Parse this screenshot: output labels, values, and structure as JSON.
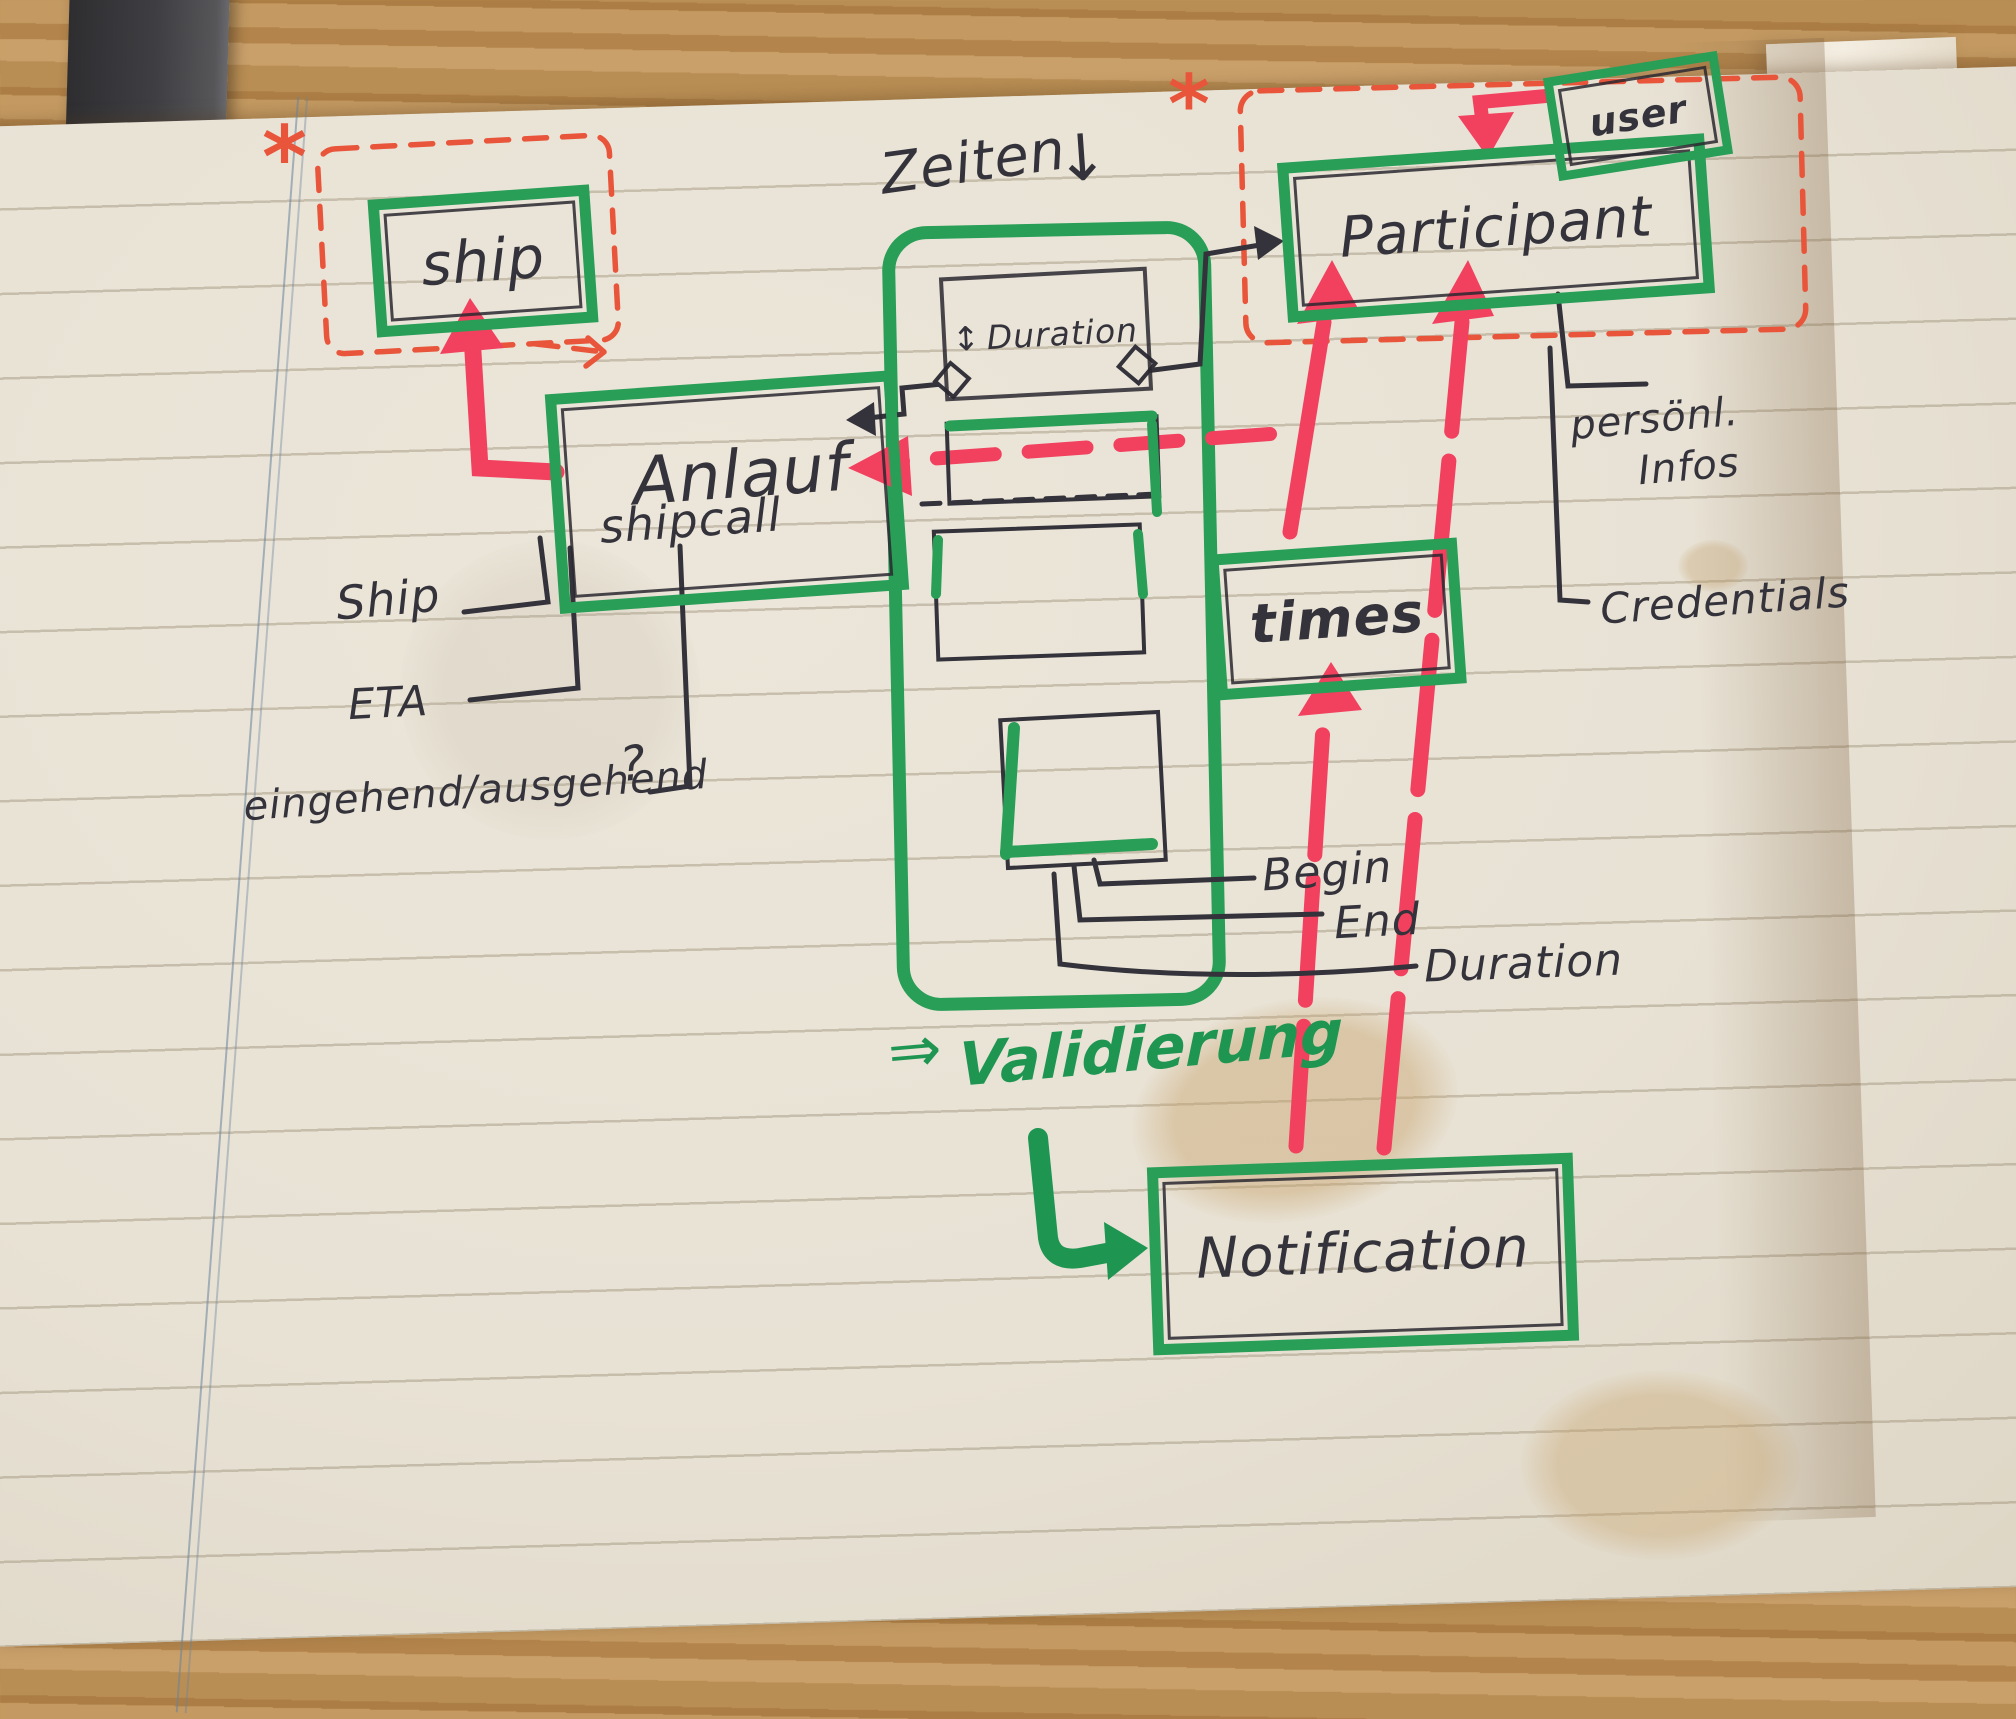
{
  "meta": {
    "description": "Hand-drawn entity sketch (ship call data model) in a paper notebook"
  },
  "colors": {
    "green_marker": "#289e57",
    "red_marker": "#f2415e",
    "orange_dashed": "#e8553a",
    "ink": "#34323a",
    "paper": "#e8e2d5"
  },
  "boxes": {
    "ship": {
      "label": "ship"
    },
    "anlauf": {
      "label_main": "Anlauf",
      "label_sub": "shipcall"
    },
    "duration": {
      "label": "Duration",
      "resize_icon": "↕"
    },
    "participant": {
      "label": "Participant"
    },
    "user": {
      "label": "user"
    },
    "times": {
      "label": "times"
    },
    "notification": {
      "label": "Notification"
    }
  },
  "labels": {
    "zeiten": "Zeiten",
    "zeiten_arrow": "↓",
    "asterisk_left": "*",
    "asterisk_right": "*",
    "ship_attr": "Ship",
    "eta": "ETA",
    "in_out": "eingehend/ausgehend",
    "question_mark": "?",
    "begin": "Begin",
    "end": "End",
    "duration_attr": "Duration",
    "personal_line1": "persönl.",
    "personal_line2": "Infos",
    "credentials": "Credentials",
    "validierung_arrow": "⇒",
    "validierung": "Validierung"
  }
}
